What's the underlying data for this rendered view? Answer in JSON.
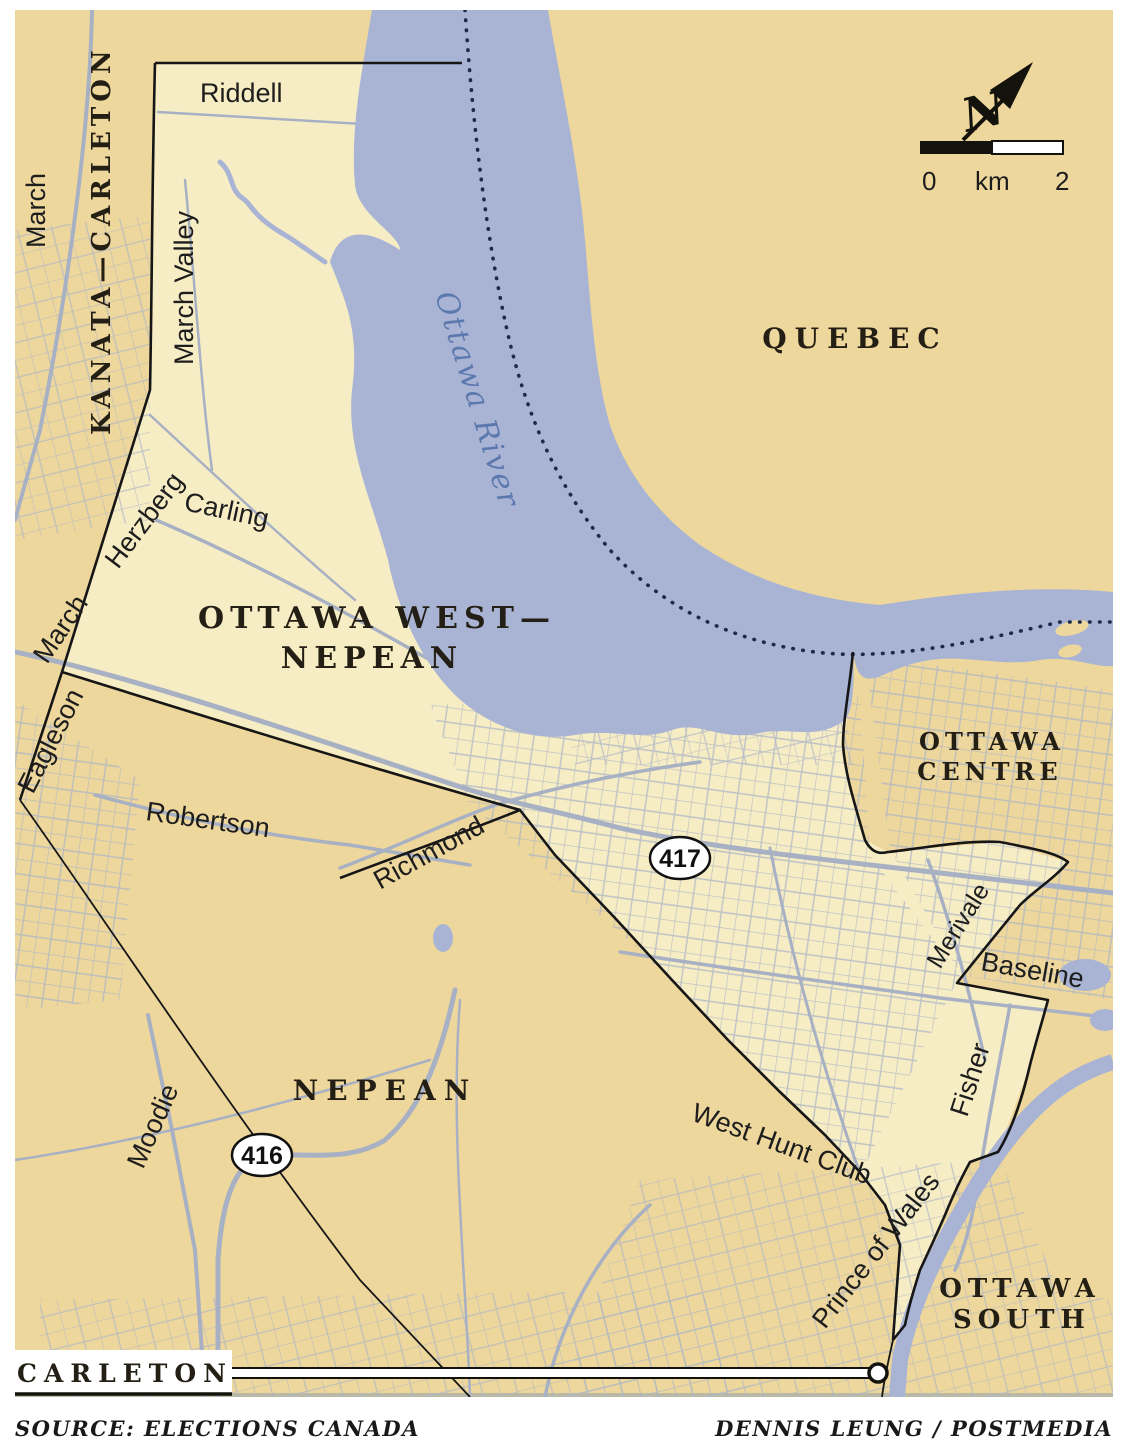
{
  "map": {
    "region_labels": {
      "kanata_carleton": "KANATA—CARLETON",
      "ottawa_west_line1": "OTTAWA WEST—",
      "ottawa_west_line2": "NEPEAN",
      "quebec": "QUEBEC",
      "ottawa_centre_line1": "OTTAWA",
      "ottawa_centre_line2": "CENTRE",
      "nepean": "NEPEAN",
      "ottawa_south_line1": "OTTAWA",
      "ottawa_south_line2": "SOUTH",
      "carleton": "CARLETON"
    },
    "road_labels": {
      "riddell": "Riddell",
      "march_top": "March",
      "march_valley": "March Valley",
      "herzberg": "Herzberg",
      "carling": "Carling",
      "march_mid": "March",
      "eagleson": "Eagleson",
      "robertson": "Robertson",
      "richmond": "Richmond",
      "merivale": "Merivale",
      "baseline": "Baseline",
      "fisher": "Fisher",
      "moodie": "Moodie",
      "west_hunt_club": "West Hunt Club",
      "prince_of_wales": "Prince of Wales"
    },
    "water_labels": {
      "ottawa_river": "Ottawa River"
    },
    "highway_shields": {
      "h417": "417",
      "h416": "416"
    },
    "scale_bar": {
      "zero": "0",
      "unit": "km",
      "two": "2"
    },
    "north_arrow": {
      "letter": "N"
    },
    "colors": {
      "land": "#eed79c",
      "district": "#f7edc5",
      "water": "#a9b4d5",
      "road": "#a8b1c3",
      "boundary": "#161616",
      "provincial_dotted": "#1c2a4d",
      "river_label": "#5c79ae",
      "shield_fill": "#ffffff"
    }
  },
  "footer": {
    "source": "SOURCE: ELECTIONS CANADA",
    "credit": "DENNIS LEUNG / POSTMEDIA"
  }
}
